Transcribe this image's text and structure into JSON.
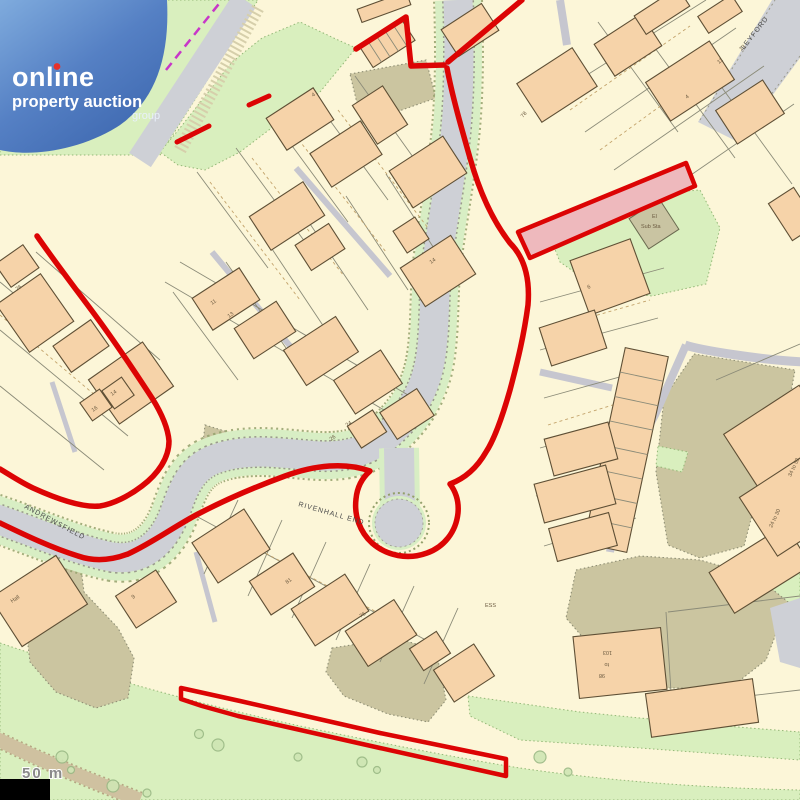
{
  "page": {
    "type": "property-auction-map-screenshot"
  },
  "logo": {
    "line1": "online",
    "line2": "property auction",
    "line3": "group"
  },
  "streets": {
    "andrewsfield": "ANDREWSFIELD",
    "rivenhall_end": "RIVENHALL END",
    "leyford": "LEYFORD"
  },
  "map_labels": {
    "el": "El",
    "sub_sta": "Sub Sta",
    "ess": "ESS",
    "hall": "Hall",
    "scale": "50 m"
  },
  "plot_numbers": [
    "4",
    "6",
    "78",
    "11",
    "13",
    "4",
    "16",
    "14",
    "11",
    "13",
    "24",
    "26",
    "14",
    "81",
    "76",
    "9",
    "76",
    "103",
    "to",
    "98",
    "34 to 52",
    "24 to 30"
  ],
  "colors": {
    "boundary_red": "#dc0404",
    "road_gray": "#ced0d6",
    "building_fill": "#f6d3a9",
    "green_space": "#d9efbe",
    "khaki": "#cbc5a0",
    "logo_blue_top": "#7fabdd",
    "logo_blue_bottom": "#3c66ae",
    "magenta_route": "#c837c8",
    "scale_bar": "#000000"
  }
}
